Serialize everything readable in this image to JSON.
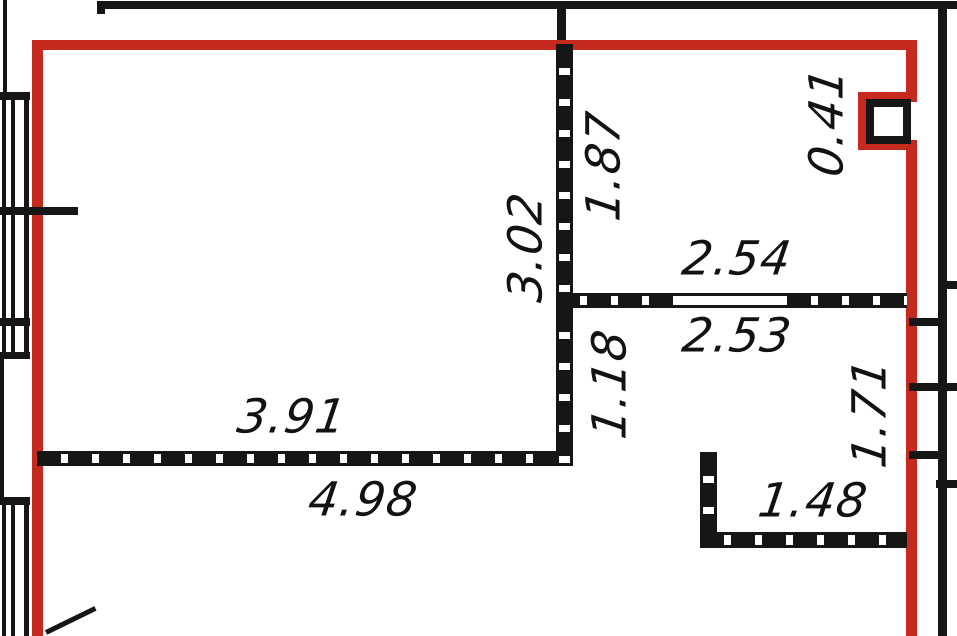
{
  "plan": {
    "name": "apartment-floor-plan",
    "unit": "m",
    "colors": {
      "outline": "#c62a1f",
      "walls": "#161616",
      "background": "#ffffff"
    },
    "dimensions": {
      "dim_187": {
        "value": "1.87",
        "orientation": "vertical"
      },
      "dim_302": {
        "value": "3.02",
        "orientation": "vertical"
      },
      "dim_254": {
        "value": "2.54",
        "orientation": "horizontal"
      },
      "dim_253": {
        "value": "2.53",
        "orientation": "horizontal"
      },
      "dim_118": {
        "value": "1.18",
        "orientation": "vertical"
      },
      "dim_391": {
        "value": "3.91",
        "orientation": "horizontal"
      },
      "dim_498": {
        "value": "4.98",
        "orientation": "horizontal"
      },
      "dim_041": {
        "value": "0.41",
        "orientation": "vertical"
      },
      "dim_171": {
        "value": "1.71",
        "orientation": "vertical"
      },
      "dim_148": {
        "value": "1.48",
        "orientation": "horizontal"
      }
    }
  }
}
